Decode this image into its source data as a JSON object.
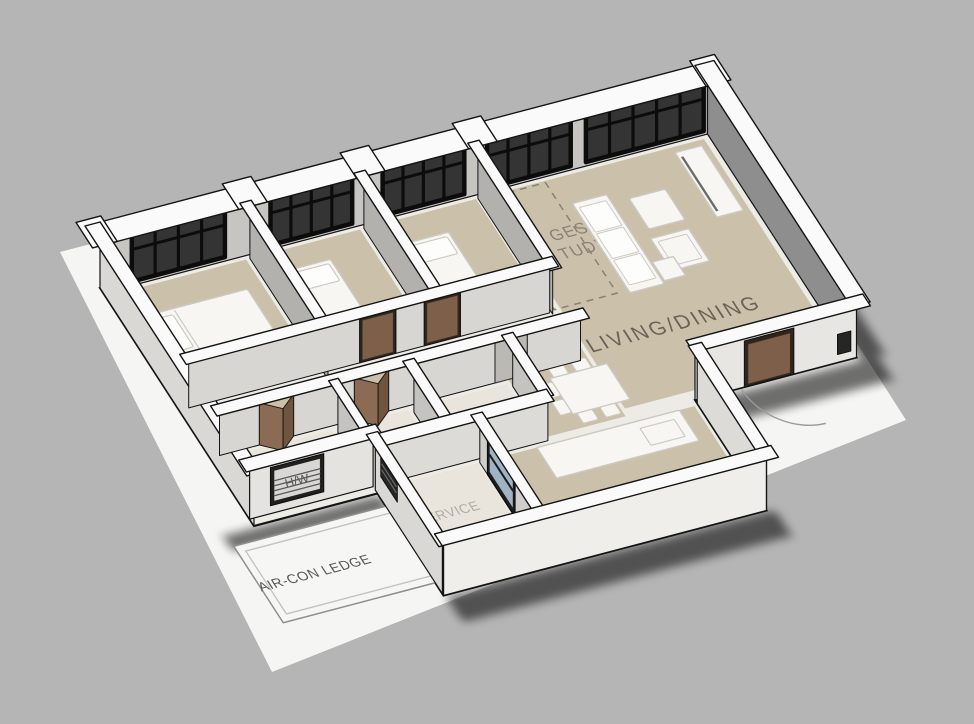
{
  "scene": {
    "type": "3d-floorplan-render",
    "background": "#b5b5b5",
    "ground": "#f5f5f4"
  },
  "colors": {
    "slab": "#edebe5",
    "floor_beige": "#cbc1ab",
    "floor_light": "#e9e5dc",
    "wall_top": "#fafafa",
    "outline": "#141414",
    "face_back": "#c7c5c1",
    "face_dark": "#8e8e8e",
    "face_mid": "#b3b1ad",
    "face_light": "#d8d6d2",
    "face_bright": "#e7e6e3",
    "face_front": "#efeeeb",
    "face_left": "#d9d8d5",
    "window_frame": "#0c0c0c",
    "window_glass": "#343434",
    "door_brown": "#7d5f4a",
    "door_frame": "#2e241c",
    "bifold_light": "#8b6b53",
    "bifold_dark": "#6f5440",
    "bath_door_gray": "#bbb9b4",
    "glass_blue": "#a7bccd",
    "furniture_fill": "#f7f6f3",
    "furniture_stroke": "#ccc9c2",
    "label": "#6b6257",
    "label_faint": "#b1ada5",
    "label_dark": "#575757",
    "swing_arc": "#9b9b9b",
    "study_dash": "#8a8175",
    "ledge_border": "#8f8f8f"
  },
  "labels": {
    "main_bedroom": "MAIN",
    "living_dining": "LIVING/DINING",
    "study_fragment_1": "GESTED",
    "study_fragment_2": "TUDY",
    "aircon_ledge": "AIR-CON LEDGE",
    "service": "SERVICE",
    "hw": "H/W"
  }
}
